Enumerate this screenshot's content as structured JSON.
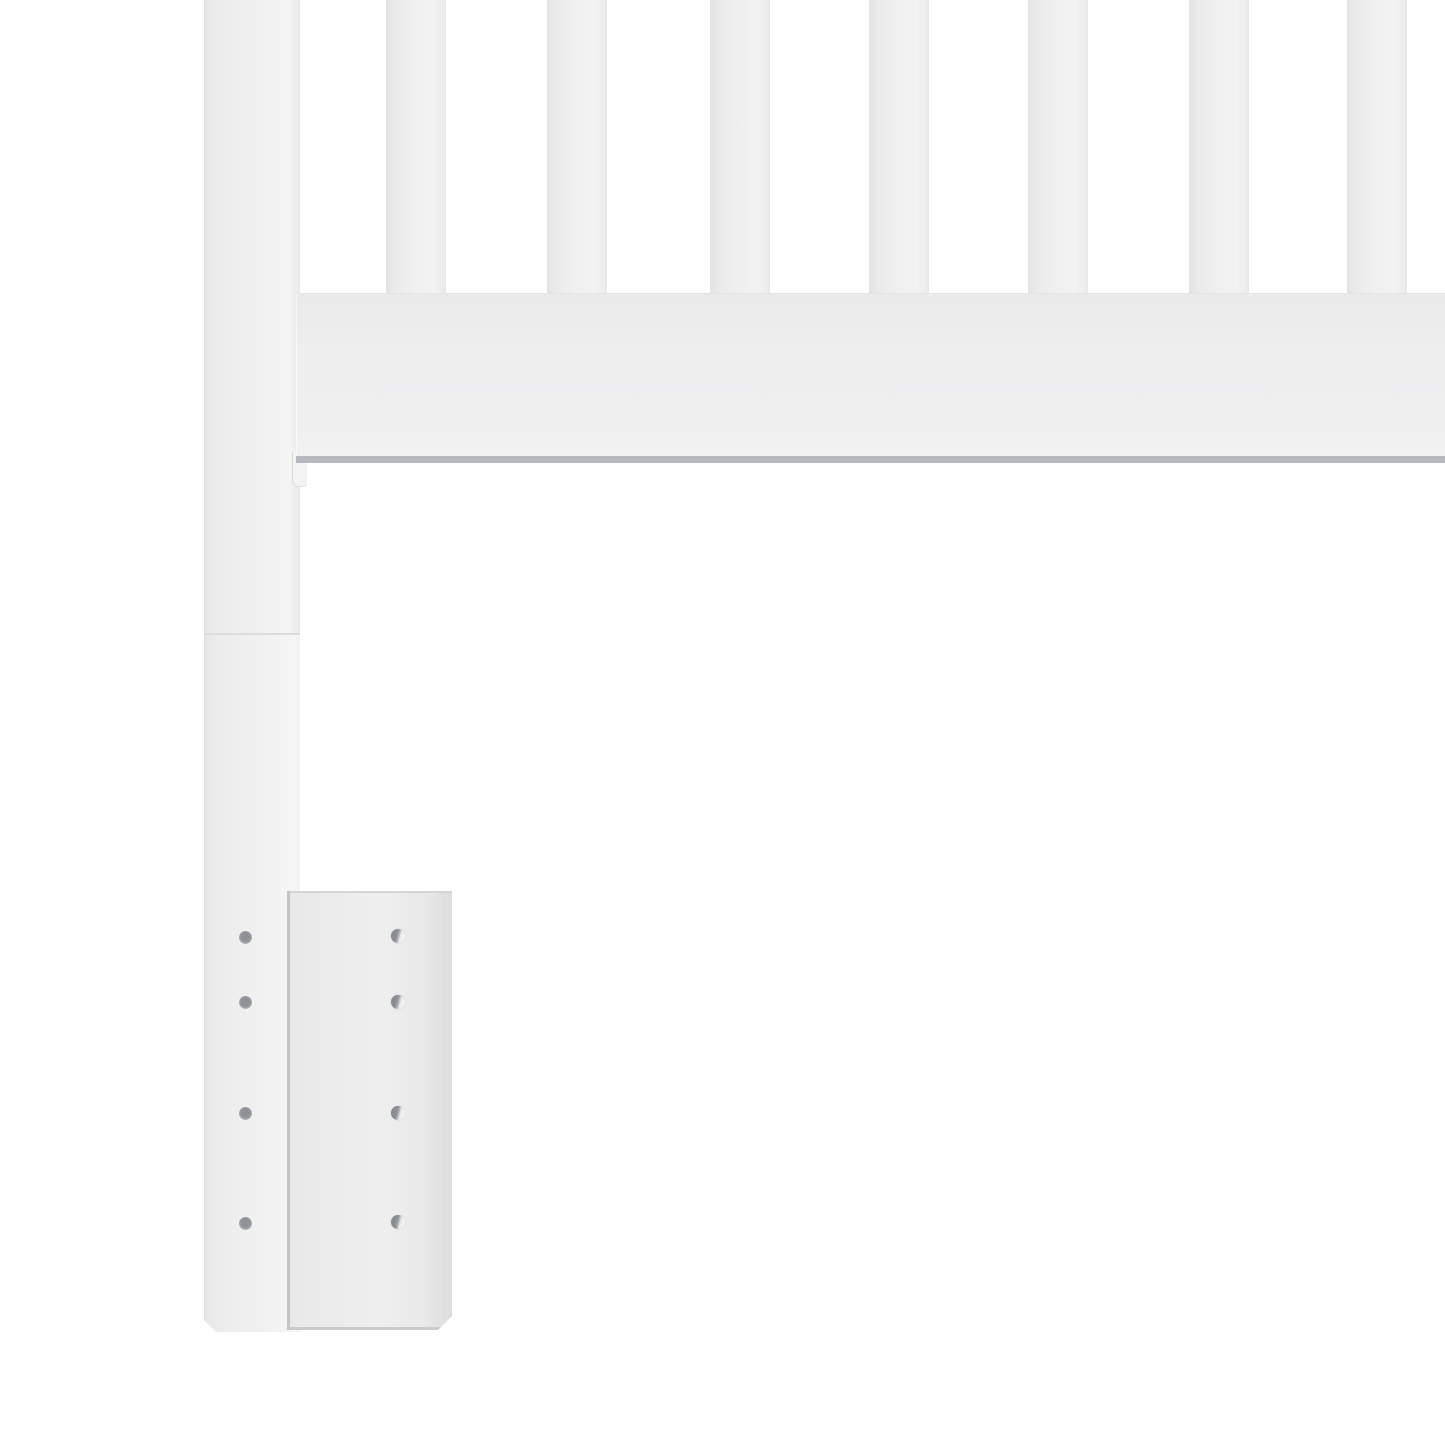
{
  "meta": {
    "description": "Product photo close-up: lower-left corner of a white wooden slatted bed headboard, showing the square leg post, seven vertical slats, the horizontal bottom rail, a joint seam on the leg, and a white metal mounting bracket plate with screw holes",
    "subject": "white slatted headboard corner with mounting bracket",
    "visible_text": ""
  },
  "colors": {
    "background": "#ffffff",
    "wood_face": "#efeff0",
    "wood_shade": "#e5e5e6",
    "wood_highlight": "#f6f6f7",
    "rail_bottom_edge": "#b6b9bb",
    "seam_line": "#dcdcdd",
    "bracket_face": "#ececed",
    "bracket_edge_dark": "#c2c4c6",
    "hole_dark": "#8e9296",
    "hole_light": "#fdfdfd"
  },
  "scene": {
    "canvas": {
      "width": 1445,
      "height": 1445
    },
    "leg": {
      "x": 204,
      "y": 0,
      "width": 96,
      "height": 1332,
      "seam_y": 633,
      "chamfer": 12
    },
    "slats": {
      "width": 60,
      "height": 293,
      "x_positions": [
        386,
        547,
        710,
        869,
        1028,
        1189,
        1347
      ]
    },
    "rail": {
      "x": 296,
      "y": 293,
      "width": 1149,
      "height": 163
    },
    "tenon": {
      "x": 292,
      "y": 452,
      "width": 14,
      "height": 34
    },
    "bracket": {
      "x": 287,
      "y": 891,
      "width": 165,
      "height": 439,
      "chamfer": 14
    },
    "leg_holes": {
      "cx": 245,
      "diameter": 13,
      "cy_positions": [
        937,
        1002,
        1113,
        1223
      ]
    },
    "bracket_holes": {
      "cx": 398,
      "diameter": 14,
      "cy_positions": [
        936,
        1002,
        1113,
        1222
      ]
    }
  }
}
